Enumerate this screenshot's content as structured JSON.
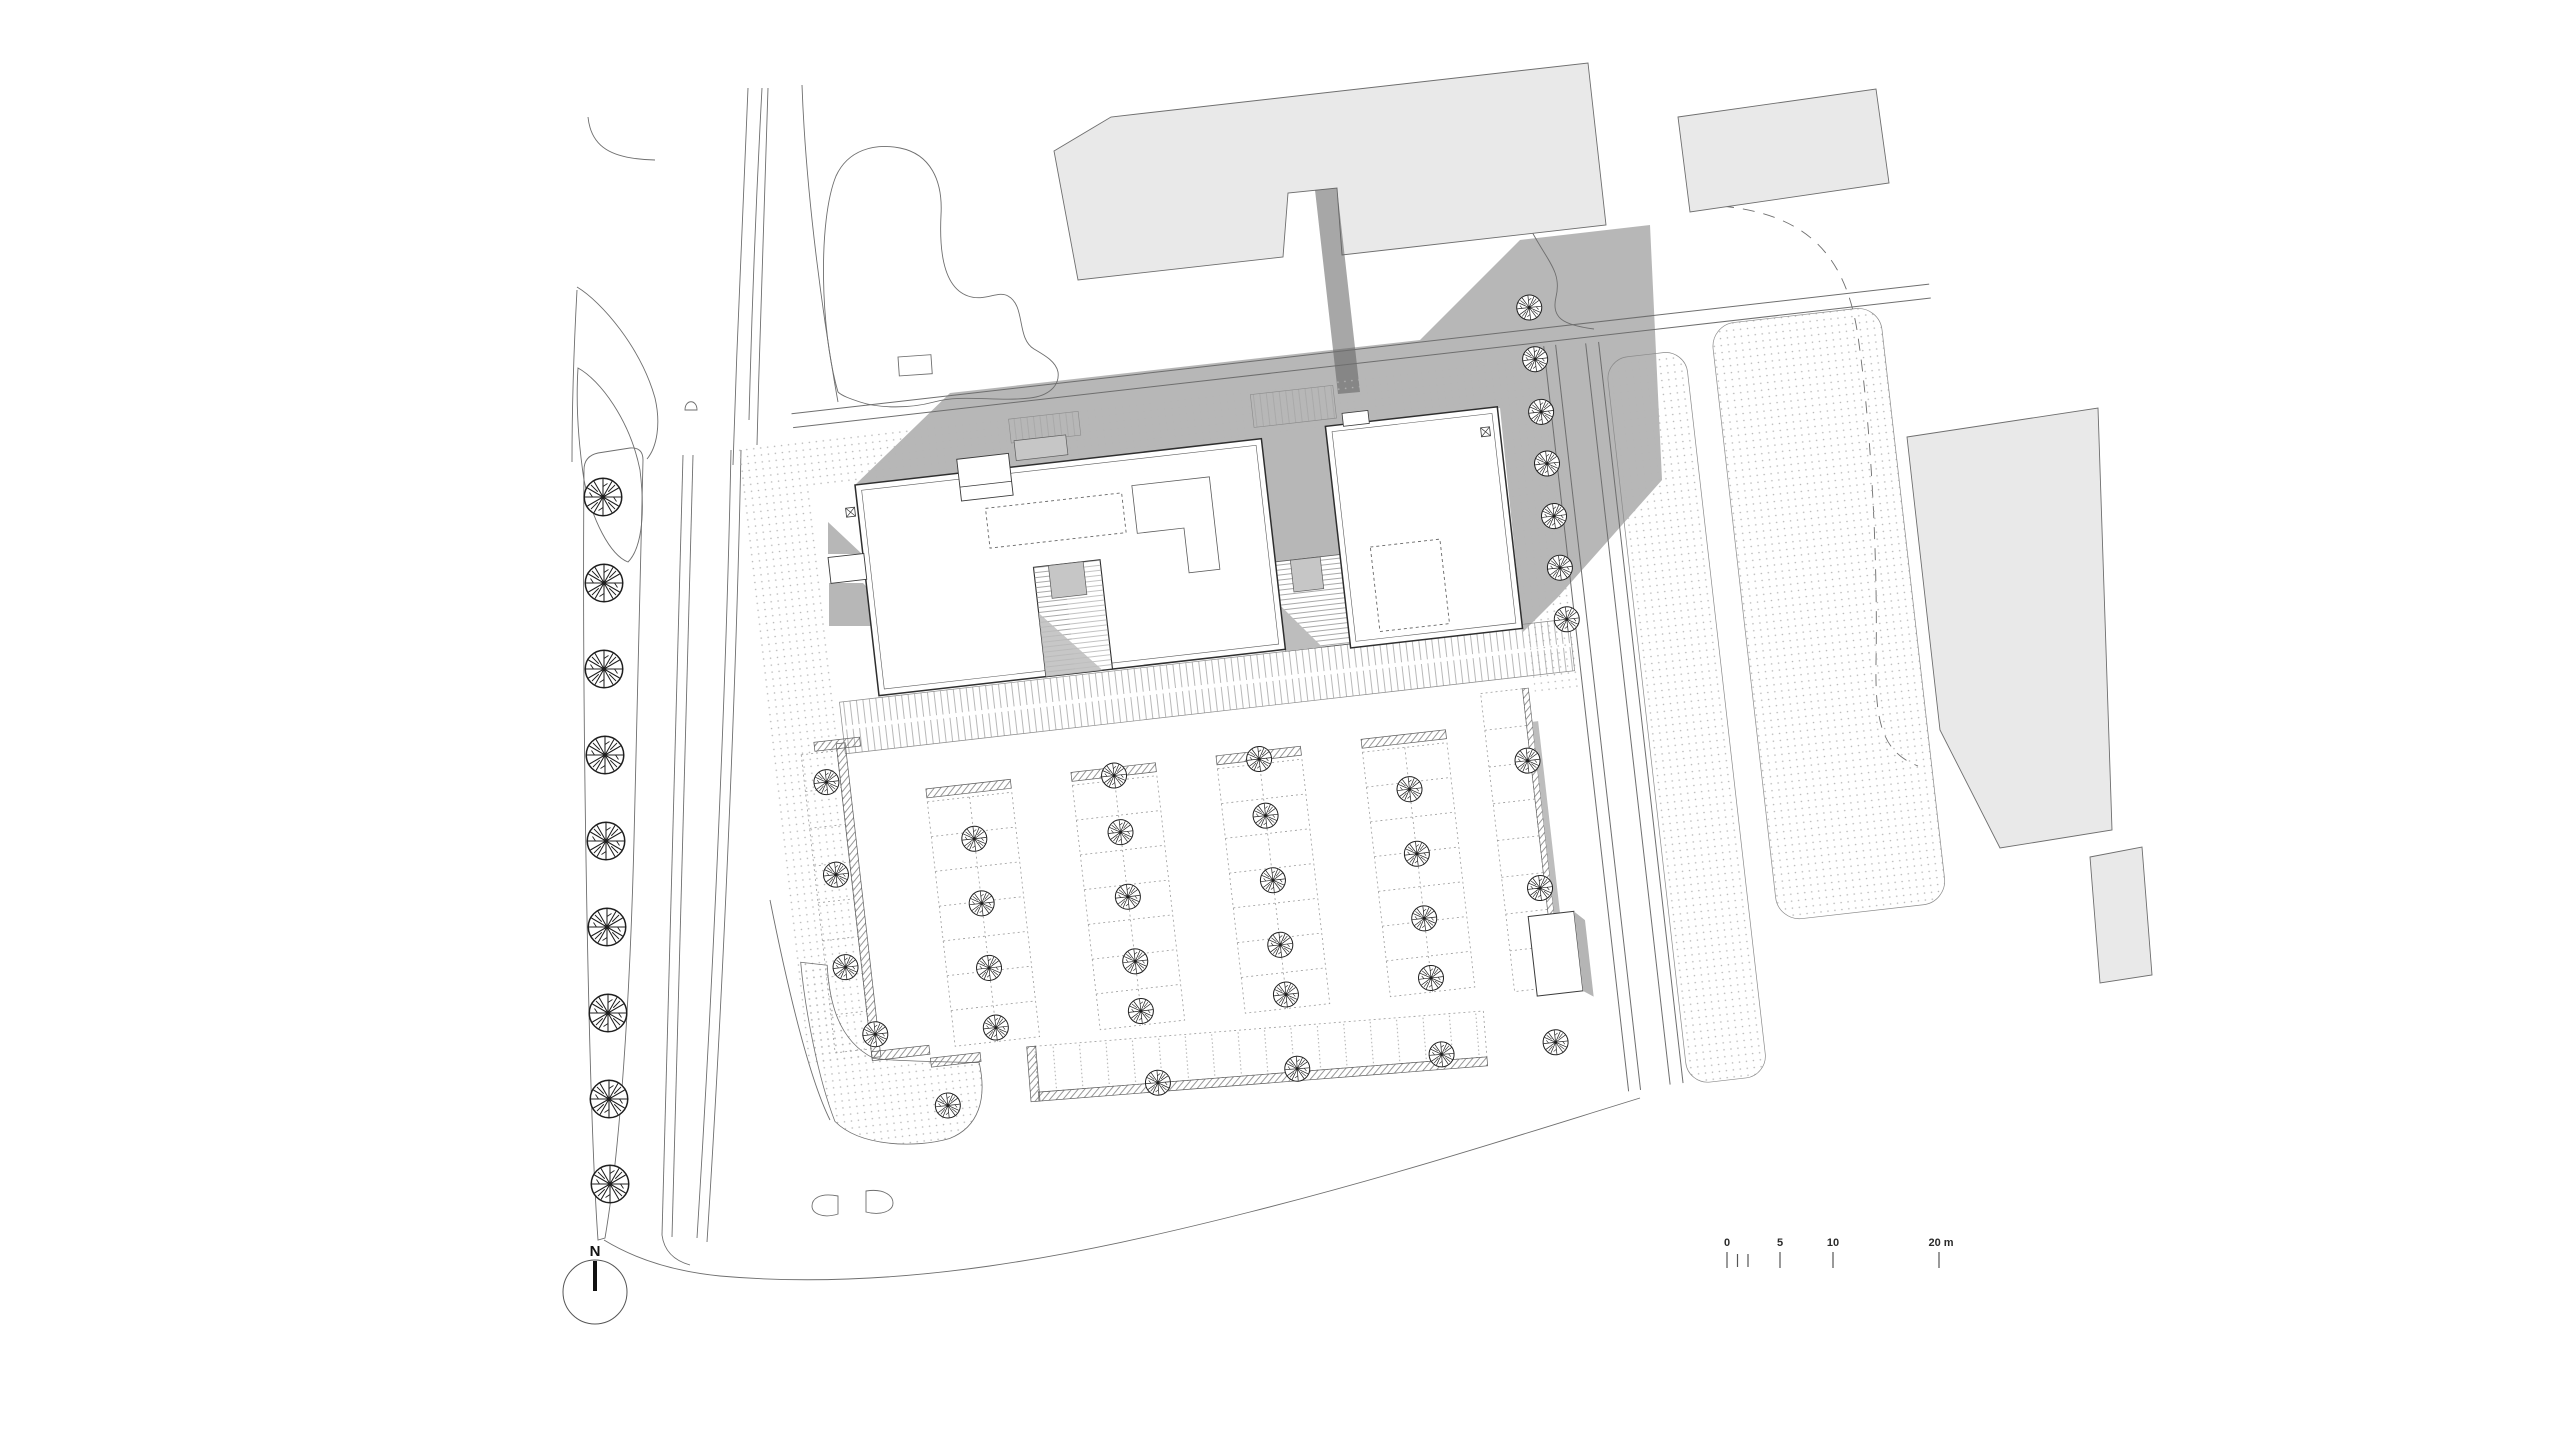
{
  "compass": {
    "label": "N"
  },
  "scale_bar": {
    "labels": [
      "0",
      "5",
      "10",
      "20 m"
    ],
    "major_ticks_m": [
      0,
      5,
      10,
      20
    ]
  },
  "colors": {
    "paper": "#ffffff",
    "context_building": "#e9e9e9",
    "context_outline": "#6e6e6e",
    "shadow": "#6f6f6f",
    "bridge": "#5e5e5e",
    "main_building_fill": "#ffffff",
    "main_building_outline": "#2e2e2e",
    "roof_block": "#c6c6c6",
    "thin_line": "#6e6e6e",
    "stall_line": "#9b9b9b",
    "tree_stroke": "#1f1f1f"
  }
}
